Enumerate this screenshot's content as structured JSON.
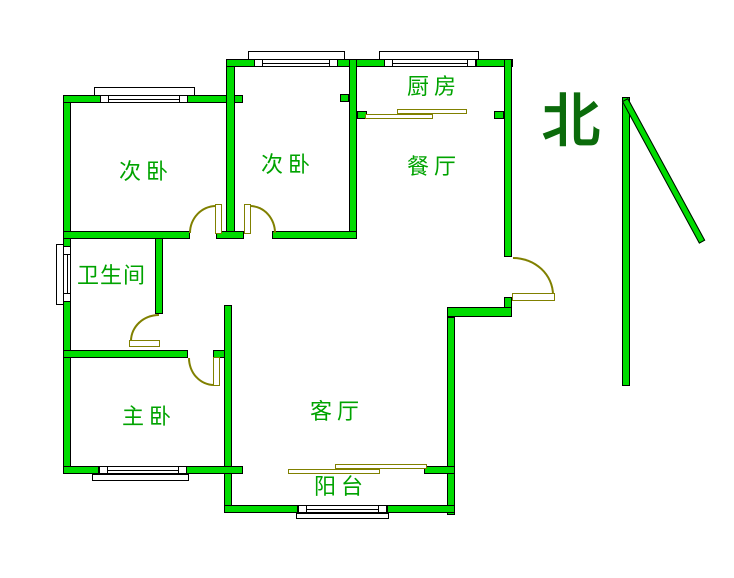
{
  "compass": {
    "label": "北"
  },
  "rooms": {
    "bedroom_left": {
      "label": "次卧"
    },
    "bedroom_right": {
      "label": "次卧"
    },
    "kitchen": {
      "label": "厨房"
    },
    "dining": {
      "label": "餐厅"
    },
    "bathroom": {
      "label": "卫生间"
    },
    "master": {
      "label": "主卧"
    },
    "living": {
      "label": "客厅"
    },
    "balcony": {
      "label": "阳台"
    }
  },
  "colors": {
    "wall_green": "#00DC00",
    "label_green": "#00A300",
    "compass_green": "#0B6B0B",
    "symbol_olive": "#808000"
  }
}
